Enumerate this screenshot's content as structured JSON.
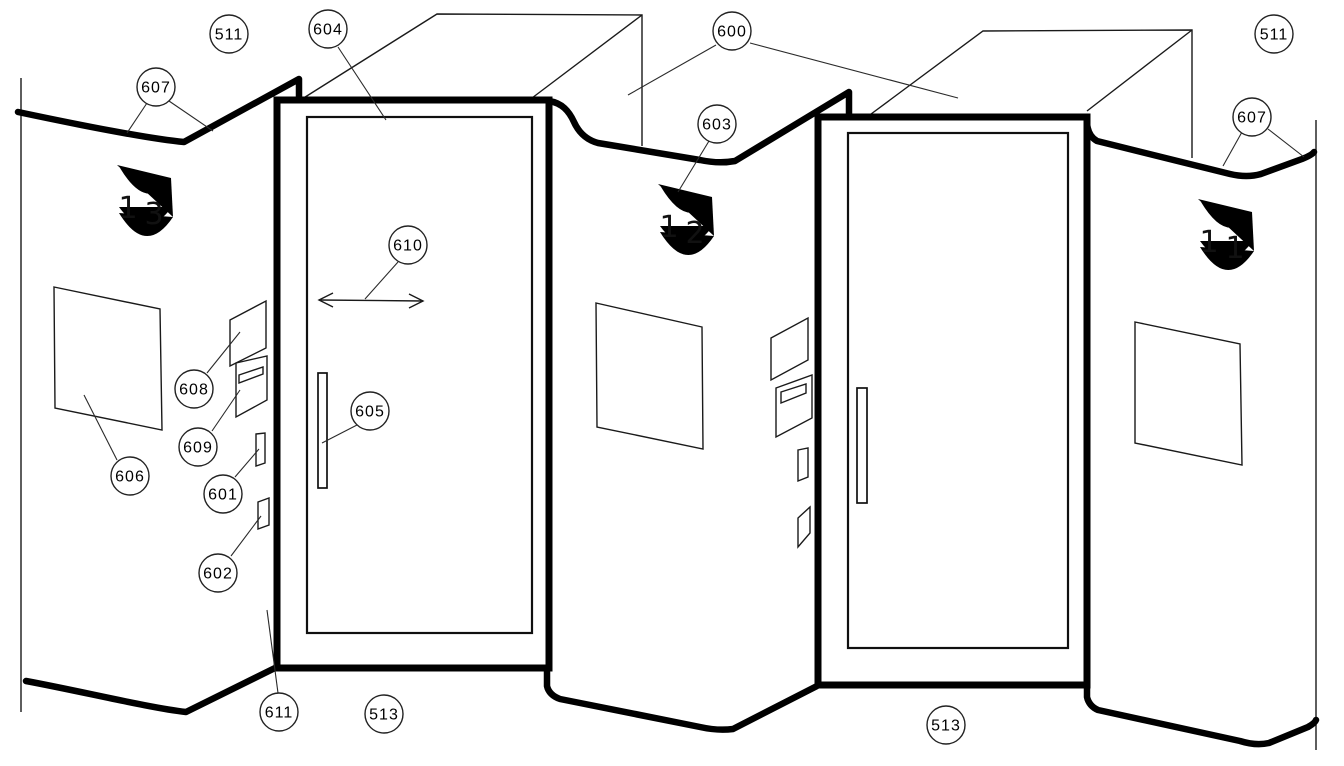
{
  "figure": {
    "colors": {
      "background": "#ffffff",
      "line": "#000000"
    },
    "labels": {
      "l511_left": "511",
      "l604": "604",
      "l600": "600",
      "l511_right": "511",
      "l607_left": "607",
      "l603": "603",
      "l607_right": "607",
      "l610": "610",
      "l608": "608",
      "l609": "609",
      "l605": "605",
      "l601": "601",
      "l606": "606",
      "l602": "602",
      "l611": "611",
      "l513_left": "513",
      "l513_right": "513"
    },
    "lamps": {
      "left": {
        "d1": "1",
        "d2": "3"
      },
      "middle": {
        "d1": "1",
        "d2": "2"
      },
      "right": {
        "d1": "1",
        "d2": "1"
      }
    }
  }
}
